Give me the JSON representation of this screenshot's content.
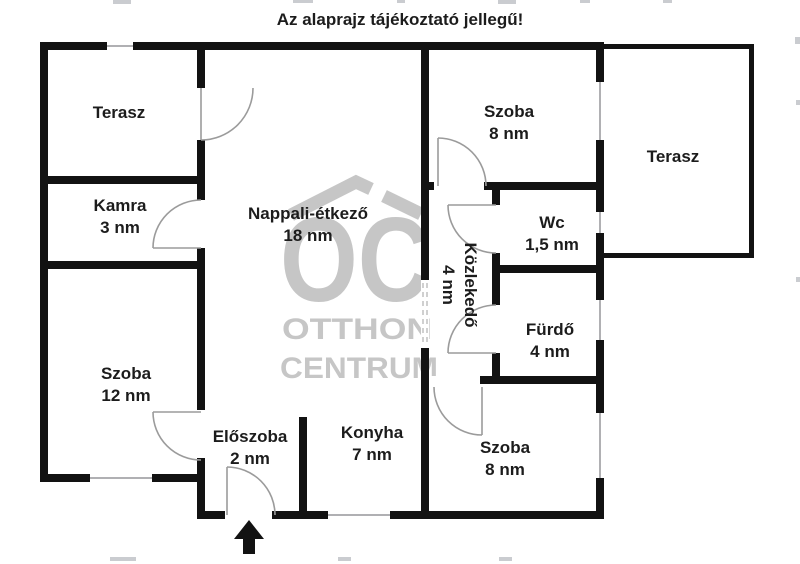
{
  "title": "Az alaprajz tájékoztató jellegű!",
  "watermark": {
    "logo": "OC",
    "line1": "OTTHON",
    "line2": "CENTRUM"
  },
  "rooms": [
    {
      "name": "Terasz",
      "area": ""
    },
    {
      "name": "Kamra",
      "area": "3 nm"
    },
    {
      "name": "Szoba",
      "area": "12 nm"
    },
    {
      "name": "Nappali-étkező",
      "area": "18 nm"
    },
    {
      "name": "Előszoba",
      "area": "2 nm"
    },
    {
      "name": "Konyha",
      "area": "7 nm"
    },
    {
      "name": "Szoba",
      "area": "8 nm"
    },
    {
      "name": "Terasz",
      "area": ""
    },
    {
      "name": "Wc",
      "area": "1,5 nm"
    },
    {
      "name": "Közlekedő",
      "area": "4 nm"
    },
    {
      "name": "Fürdő",
      "area": "4 nm"
    },
    {
      "name": "Szoba",
      "area": "8 nm"
    }
  ],
  "colors": {
    "wall": "#121212",
    "door_line": "#9b9b9b",
    "window_line": "#b0b0b3",
    "watermark": "#c6c6c6",
    "text": "#1c1c1c"
  }
}
